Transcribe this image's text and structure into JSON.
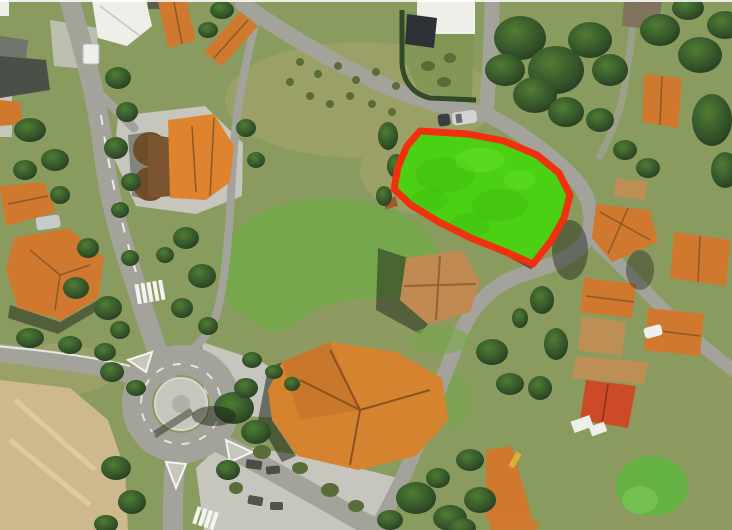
{
  "app": {
    "type": "aerial-satellite-view",
    "description": "Aerial satellite photo of a village area with one land parcel highlighted in green with a red boundary"
  },
  "parcel": {
    "name": "highlighted-land-parcel",
    "points": "420,131 468,134 504,141 537,155 559,173 570,195 564,218 551,241 533,264 506,252 471,238 439,222 411,205 394,189 398,167 407,146",
    "fill_color": "#4ad114",
    "outline_color": "#f2300e",
    "outline_width": "7"
  },
  "palette": {
    "grass_base": "#8a9b60",
    "field_bright": "#74a84a",
    "field_olive": "#8d9a60",
    "scrub_brown": "#9aa066",
    "tree_dark": "#2e4a24",
    "road": "#a3a39b",
    "pavement": "#c6c6be",
    "dirt": "#cdb98d",
    "roof_orange": "#d0792e",
    "roof_red": "#cc4a26",
    "roof_tan": "#bd8f55",
    "roof_white": "#efefe9",
    "roof_dark": "#4a4f48",
    "marking_white": "#f5f5f0",
    "shadow": "#1c2416"
  },
  "features": [
    "highlighted-land-parcel",
    "roundabout",
    "village-roads",
    "residential-houses-orange-roofs",
    "round-roof-chapel-building",
    "large-community-hall",
    "tree-clusters",
    "scrub-fields",
    "dirt-lot",
    "pedestrian-crosswalks",
    "parked-vehicles",
    "plaza-parking-area"
  ]
}
